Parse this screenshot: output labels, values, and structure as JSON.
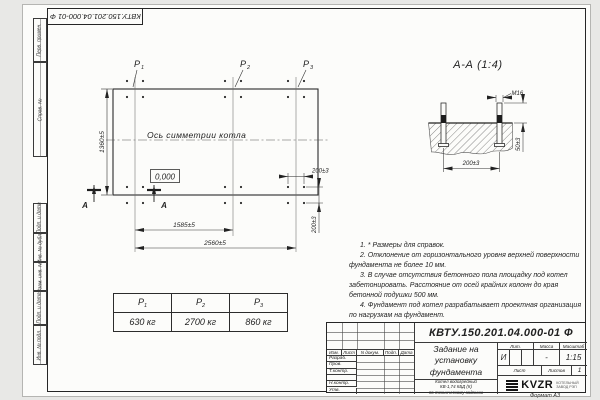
{
  "sheet": {
    "designation": "КВТУ.150.201.04.000-01 Ф",
    "format_label": "Формат А3"
  },
  "margins": {
    "perv_primen": "Перв. примен.",
    "sprav_no": "Справ. №",
    "podp_data_1": "Подп. и дата",
    "inv_dubl": "Инв. № дубл.",
    "vzam_inv": "Взам. инв. №",
    "podp_data_2": "Подп. и дата",
    "inv_podl": "Инв. № подл."
  },
  "plan": {
    "axis_label": "Ось симметрии котла",
    "elevation": "0,000",
    "section_letter": "А",
    "loads": [
      {
        "base": "P",
        "sub": "1"
      },
      {
        "base": "P",
        "sub": "2"
      },
      {
        "base": "P",
        "sub": "3"
      }
    ],
    "dims": {
      "height": "1360±5",
      "span": "1585±5",
      "total": "2560±5",
      "bolt_x": "200±3",
      "bolt_y": "200±3"
    }
  },
  "section": {
    "title": "А-А (1:4)",
    "thread": "М16",
    "dims": {
      "spacing": "200±3",
      "protrusion": "50±3"
    }
  },
  "notes": [
    "1. * Размеры для справок.",
    "2. Отклонение от горизонтального уровня верхней поверхности фундамента не более 10 мм.",
    "3. В случае отсутствия бетонного пола площадку под котел забетонировать. Расстояние от осей крайних колонн до края бетонной подушки 500 мм.",
    "4. Фундамент под котел разрабатывает проектная организация по нагрузкам на фундамент."
  ],
  "load_table": {
    "headers": [
      {
        "base": "P",
        "sub": "1"
      },
      {
        "base": "P",
        "sub": "2"
      },
      {
        "base": "P",
        "sub": "3"
      }
    ],
    "values": [
      "630 кг",
      "2700 кг",
      "860 кг"
    ]
  },
  "title_block": {
    "designation": "КВТУ.150.201.04.000-01 Ф",
    "doc_title": [
      "Задание на",
      "установку",
      "фундамента"
    ],
    "product": [
      "Котел водогрейный",
      "КВ-1,74 КБД (К)",
      "по техническому заданию"
    ],
    "col_headers": [
      "Изм.",
      "Лист",
      "N докум.",
      "Подп.",
      "Дата"
    ],
    "row_labels": [
      "Разраб.",
      "Пров.",
      "Т.контр.",
      "Н.контр.",
      "Утв."
    ],
    "lit_header": "Лит.",
    "mass_header": "Масса",
    "scale_header": "Масштаб",
    "lit": "И",
    "mass": "-",
    "scale": "1:15",
    "sheet_header": "Лист",
    "sheets_header": "Листов",
    "sheets": "1",
    "logo_text": "KVZR",
    "org": [
      "КОТЕЛЬНЫЙ",
      "ЗАВОД РЭП"
    ]
  }
}
